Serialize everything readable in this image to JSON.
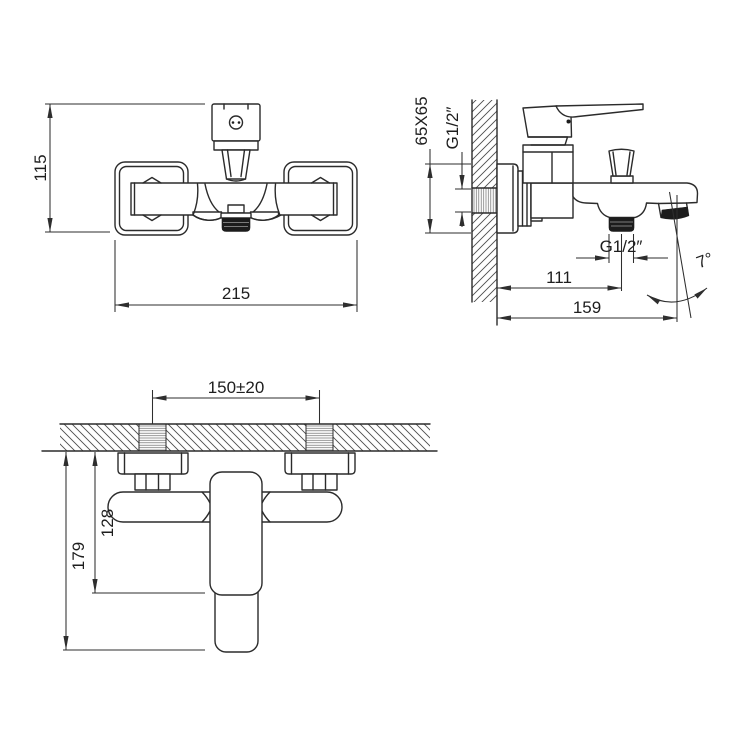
{
  "labels": {
    "front_view": {
      "height_mm": "115",
      "width_mm": "215"
    },
    "side_view": {
      "escutcheon_size": "65X65",
      "wall_thread": "G1/2″",
      "outlet_thread": "G1/2″",
      "wall_to_outlet": "111",
      "wall_to_spout_tip": "159",
      "spout_angle": "7°"
    },
    "top_view": {
      "inlet_spacing": "150±20",
      "wall_to_body_end": "128",
      "wall_to_spout_end": "179"
    }
  }
}
